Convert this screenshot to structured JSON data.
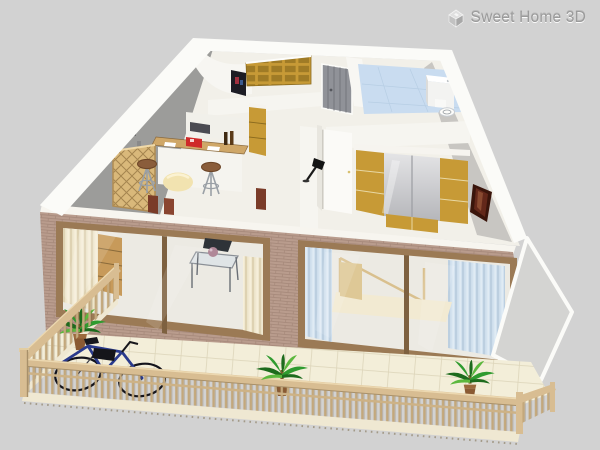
{
  "logo": {
    "text": "Sweet Home 3D",
    "icon": "sweet-home-3d-house-icon",
    "text_color": "#9b9b9b"
  },
  "view": {
    "type": "3d-home-aerial-view",
    "interaction": "drag-to-rotate"
  },
  "scene": {
    "objects": [
      "brick-facade-wall",
      "sliding-glass-window",
      "sliding-glass-window",
      "balcony-tile-floor",
      "wood-railing",
      "bicycle",
      "palm-plant",
      "palm-plant",
      "palm-plant",
      "kitchen-bar-counter",
      "bar-stool",
      "bar-stool",
      "wine-rack-shelf",
      "coffee-maker",
      "bookshelf",
      "entrance-double-door",
      "tall-gold-cabinet",
      "wall-picture",
      "bathroom-blue-floor",
      "shower-cabin",
      "toilet",
      "bedroom-wardrobe-gold-doors",
      "open-white-door",
      "floor-lamp",
      "framed-picture",
      "glass-coffee-table",
      "dining-chair",
      "bed",
      "cream-curtains",
      "blue-curtains",
      "pouf"
    ]
  },
  "colors": {
    "bg": "#d2d2d2",
    "wallWhite": "#f7f5ef",
    "edgeWhite": "#fbfbf8",
    "leftWallGray": "#9c9c9a",
    "innerWallGray": "#c8c6c2",
    "sideWallGray": "#d4d4d2",
    "interiorFloor": "#f2f0e9",
    "partitionWhite": "#f6f5f0",
    "brick": "#b99c8d",
    "brickLine": "#9d8072",
    "woodFrame": "#9b7a55",
    "woodFrameDark": "#7e6140",
    "glassFill": "#eceae3",
    "tileFloor": "#f3eed9",
    "tileLine": "#ddd5ba",
    "railWood": "#d8bd92",
    "railWoodLight": "#ecd8b0",
    "railWoodDark": "#a8906a",
    "baluster": "#c3a87c",
    "slabCream": "#efe8d2",
    "gold": "#c79a36",
    "goldDark": "#8a6a1e",
    "goldSeam": "#e8d8a4",
    "doorGray": "#909298",
    "doorGrayLine": "#75777d",
    "bathFloorBlue": "#c9dcf0",
    "bathTileLine": "#b7cee4",
    "curtainCream": "#f0e8d0",
    "curtainCreamDark": "#ded2b2",
    "curtainBlue": "#d3e2ef",
    "curtainBlueDark": "#bccfe0",
    "shelfWood": "#d9b87a",
    "latticeLine": "#a5854f",
    "counterWood": "#cfa768",
    "stoolSeat": "#8a5d3b",
    "metal": "#9aa0a6",
    "poufCream": "#f2e3b0",
    "chairRed": "#7a3b28",
    "red": "#cf2a2a",
    "dark": "#1c1c24",
    "maroon": "#63281a",
    "maroonDark": "#3a150b",
    "bikeBlue": "#2a3a8c",
    "plantGreen": "#2f9b2f",
    "plantDark": "#1d6b1d",
    "plantLight": "#5cb83e",
    "pot": "#8a5a33",
    "potRim": "#9c6a3d",
    "logoGray": "#9b9b9b",
    "mirrorLight": "#e4e4e6",
    "mirrorDark": "#b5b6ba"
  }
}
